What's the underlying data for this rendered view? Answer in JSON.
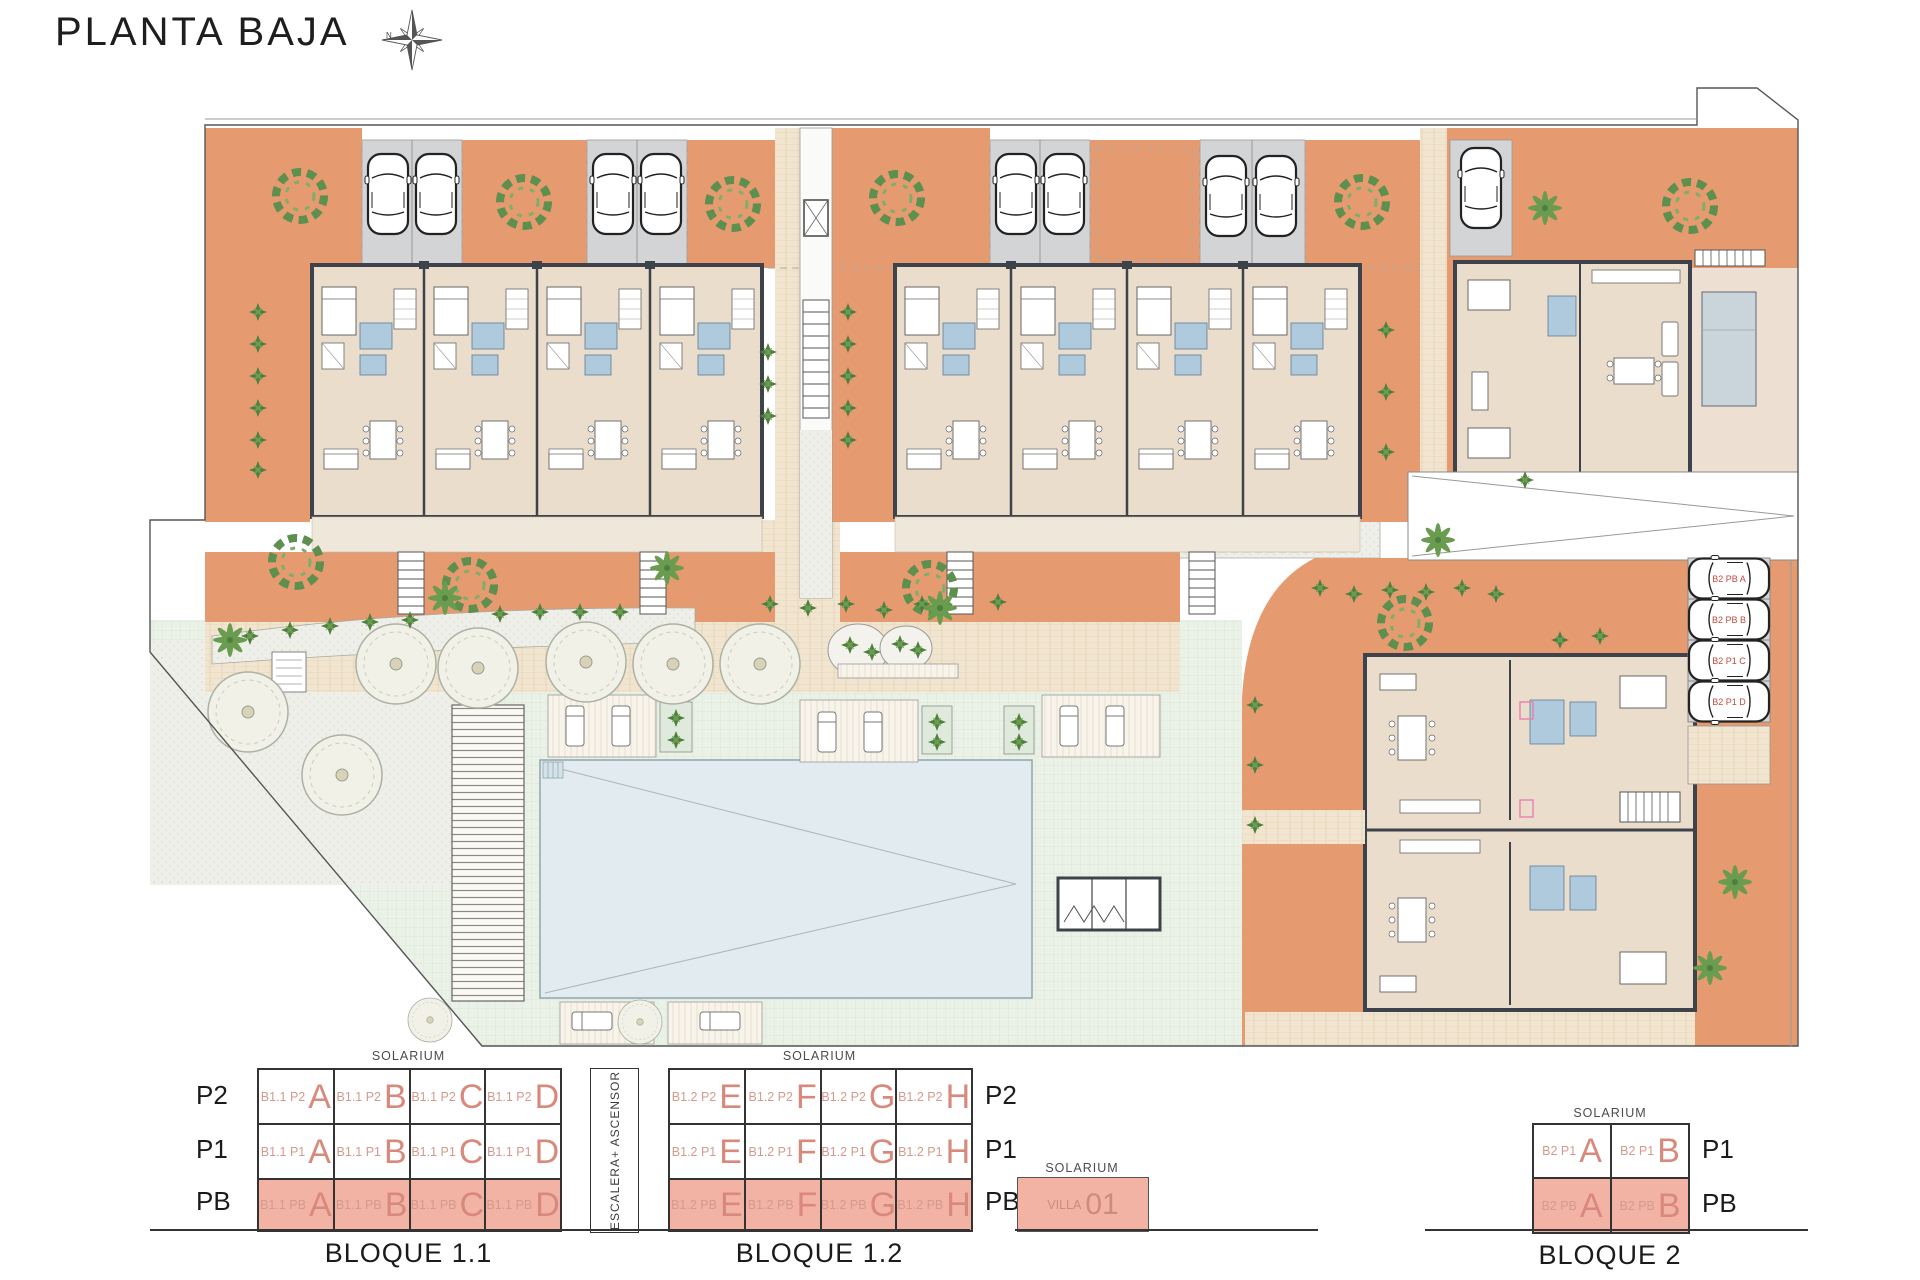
{
  "header": {
    "title": "PLANTA BAJA",
    "north_label": "N"
  },
  "colors": {
    "terrace_orange": "#E59A6F",
    "building_beige": "#EBDDCC",
    "wall_dark": "#3E434B",
    "parking_gray": "#D3D4D6",
    "lawn_green": "#EAF1E6",
    "path_beige": "#F1E5CF",
    "gravel_gray": "#EFEFE9",
    "pool_blue": "#E2EBEF",
    "bath_blue": "#AFC9DD",
    "tree_green": "#5D8F4E",
    "legend_pink": "#F2B3A5",
    "legend_text": "#D9897B",
    "legend_text_small": "#D49A8D",
    "parking_label_red": "#C24B40"
  },
  "plan": {
    "parking_labels": [
      "B2 PB A",
      "B2 PB B",
      "B2 P1 C",
      "B2 P1 D"
    ]
  },
  "legend": {
    "solarium": "SOLARIUM",
    "stairs_label": "ESCALERA+ ASCENSOR",
    "floors": [
      "P2",
      "P1",
      "PB"
    ],
    "floors_b2": [
      "P1",
      "PB"
    ],
    "bloque11": {
      "name": "BLOQUE 1.1",
      "rows": [
        {
          "floor": "P2",
          "cells": [
            {
              "code": "B1.1 P2",
              "letter": "A"
            },
            {
              "code": "B1.1 P2",
              "letter": "B"
            },
            {
              "code": "B1.1 P2",
              "letter": "C"
            },
            {
              "code": "B1.1 P2",
              "letter": "D"
            }
          ]
        },
        {
          "floor": "P1",
          "cells": [
            {
              "code": "B1.1 P1",
              "letter": "A"
            },
            {
              "code": "B1.1 P1",
              "letter": "B"
            },
            {
              "code": "B1.1 P1",
              "letter": "C"
            },
            {
              "code": "B1.1 P1",
              "letter": "D"
            }
          ]
        },
        {
          "floor": "PB",
          "cells": [
            {
              "code": "B1.1 PB",
              "letter": "A"
            },
            {
              "code": "B1.1 PB",
              "letter": "B"
            },
            {
              "code": "B1.1 PB",
              "letter": "C"
            },
            {
              "code": "B1.1 PB",
              "letter": "D"
            }
          ]
        }
      ]
    },
    "bloque12": {
      "name": "BLOQUE 1.2",
      "rows": [
        {
          "floor": "P2",
          "cells": [
            {
              "code": "B1.2 P2",
              "letter": "E"
            },
            {
              "code": "B1.2 P2",
              "letter": "F"
            },
            {
              "code": "B1.2 P2",
              "letter": "G"
            },
            {
              "code": "B1.2 P2",
              "letter": "H"
            }
          ]
        },
        {
          "floor": "P1",
          "cells": [
            {
              "code": "B1.2 P1",
              "letter": "E"
            },
            {
              "code": "B1.2 P1",
              "letter": "F"
            },
            {
              "code": "B1.2 P1",
              "letter": "G"
            },
            {
              "code": "B1.2 P1",
              "letter": "H"
            }
          ]
        },
        {
          "floor": "PB",
          "cells": [
            {
              "code": "B1.2 PB",
              "letter": "E"
            },
            {
              "code": "B1.2 PB",
              "letter": "F"
            },
            {
              "code": "B1.2 PB",
              "letter": "G"
            },
            {
              "code": "B1.2 PB",
              "letter": "H"
            }
          ]
        }
      ]
    },
    "villa": {
      "code": "VILLA",
      "number": "01",
      "floor": "PB"
    },
    "bloque2": {
      "name": "BLOQUE 2",
      "rows": [
        {
          "floor": "P1",
          "cells": [
            {
              "code": "B2 P1",
              "letter": "A"
            },
            {
              "code": "B2 P1",
              "letter": "B"
            }
          ]
        },
        {
          "floor": "PB",
          "cells": [
            {
              "code": "B2 PB",
              "letter": "A"
            },
            {
              "code": "B2 PB",
              "letter": "B"
            }
          ]
        }
      ]
    }
  }
}
